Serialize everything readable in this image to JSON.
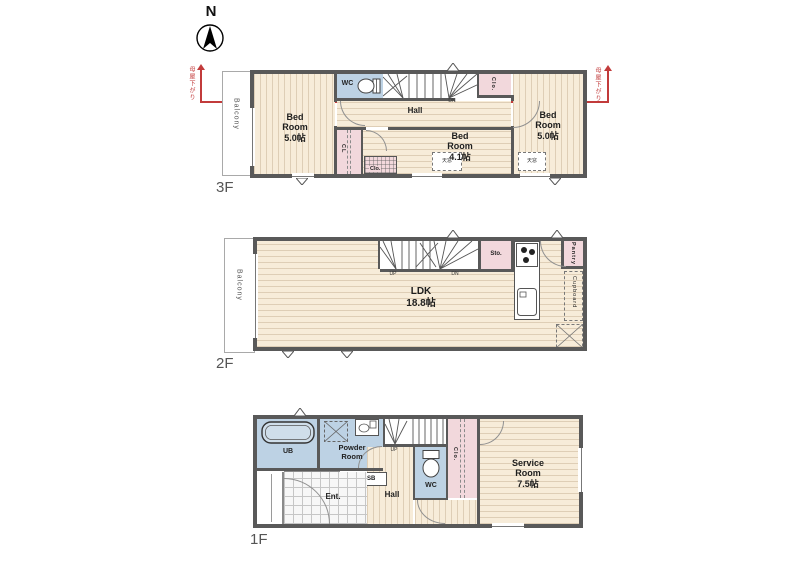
{
  "compass": {
    "north": "N"
  },
  "colors": {
    "wall": "#595959",
    "wood_floor": "#f7ecd9",
    "wet_floor": "#bdd2e4",
    "closet": "#f2d8dc",
    "slope_accent": "#c23b3b"
  },
  "f3": {
    "tag": "3F",
    "balcony": "Balcony",
    "wc": "WC",
    "hall": "Hall",
    "dn": "DN",
    "bed_left": {
      "l1": "Bed",
      "l2": "Room",
      "size": "5.0帖"
    },
    "bed_mid": {
      "l1": "Bed",
      "l2": "Room",
      "size": "4.1帖"
    },
    "bed_right": {
      "l1": "Bed",
      "l2": "Room",
      "size": "5.0帖"
    },
    "cl": "CL",
    "clo_top": "Clo.",
    "clo_small": "Clo.",
    "skylight_left": "天窓",
    "skylight_right": "天窓",
    "slope_left": "母屋下がり",
    "slope_right": "母屋下がり"
  },
  "f2": {
    "tag": "2F",
    "balcony": "Balcony",
    "up": "UP",
    "dn": "DN",
    "ldk": {
      "name": "LDK",
      "size": "18.8帖"
    },
    "sto": "Sto.",
    "pantry": "Pantry",
    "cupboard": "Cupboard"
  },
  "f1": {
    "tag": "1F",
    "ub": "UB",
    "powder": {
      "l1": "Powder",
      "l2": "Room"
    },
    "sb": "SB",
    "ent": "Ent.",
    "hall": "Hall",
    "up": "UP",
    "wc": "WC",
    "clo": "Clo.",
    "service": {
      "l1": "Service",
      "l2": "Room",
      "size": "7.5帖"
    }
  }
}
